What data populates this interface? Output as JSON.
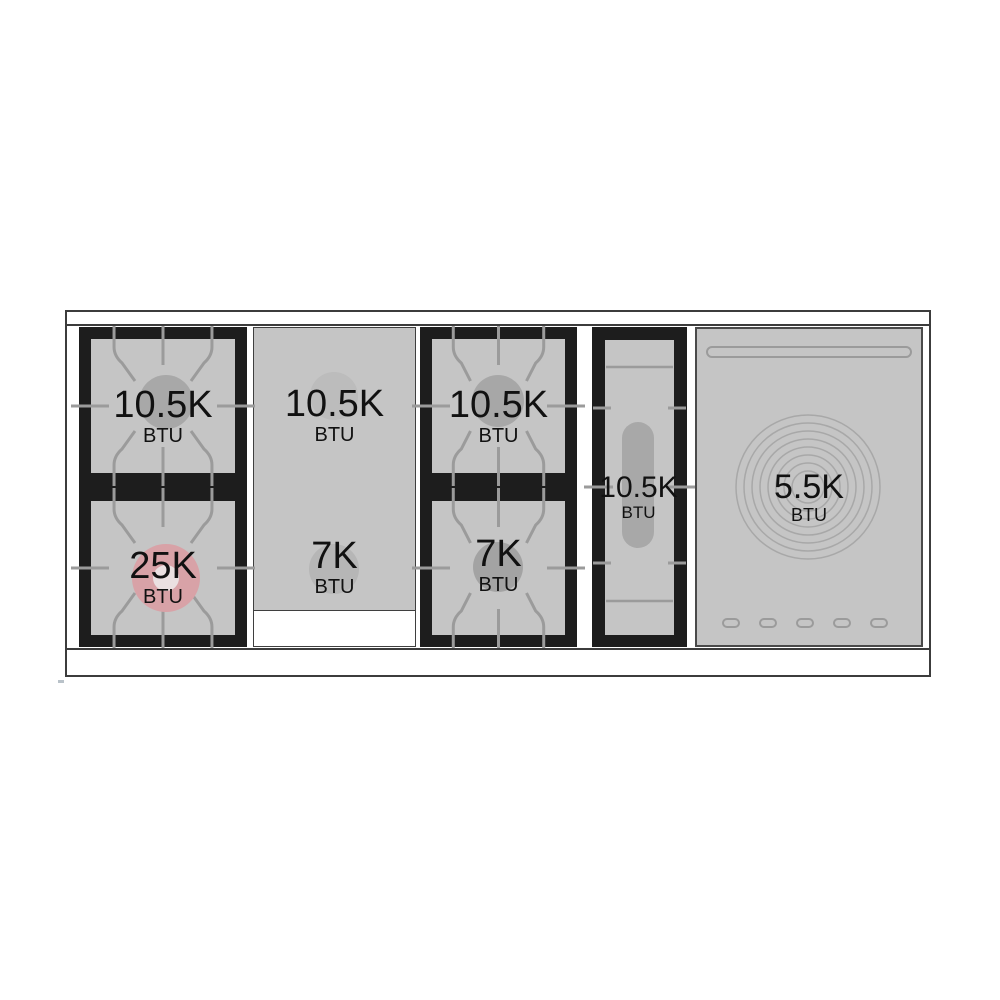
{
  "diagram": {
    "name": "rangetop-btu-diagram",
    "unit_label": "BTU"
  },
  "sections": [
    {
      "name": "left-burner-block",
      "burners": [
        {
          "value": "10.5K",
          "unit": "BTU"
        },
        {
          "value": "25K",
          "unit": "BTU"
        }
      ]
    },
    {
      "name": "griddle-plate",
      "burners": [
        {
          "value": "10.5K",
          "unit": "BTU"
        },
        {
          "value": "7K",
          "unit": "BTU"
        }
      ]
    },
    {
      "name": "center-burner-block",
      "burners": [
        {
          "value": "10.5K",
          "unit": "BTU"
        },
        {
          "value": "7K",
          "unit": "BTU"
        }
      ]
    },
    {
      "name": "fry-top",
      "burners": [
        {
          "value": "10.5K",
          "unit": "BTU"
        }
      ]
    },
    {
      "name": "french-top",
      "burners": [
        {
          "value": "5.5K",
          "unit": "BTU"
        }
      ]
    }
  ],
  "colors": {
    "panel_gray": "#c5c5c5",
    "frame_black": "#1d1d1d",
    "grate_line": "#9b9b9b",
    "burner_gray": "#a8a8a8",
    "burner_faint": "#bcbcbc",
    "burner_pink": "#d8a2a7",
    "burner_pink_center": "#eae0e1",
    "ring_line": "#a8a8a8",
    "border_dark": "#3c3c3c",
    "text": "#111111"
  }
}
